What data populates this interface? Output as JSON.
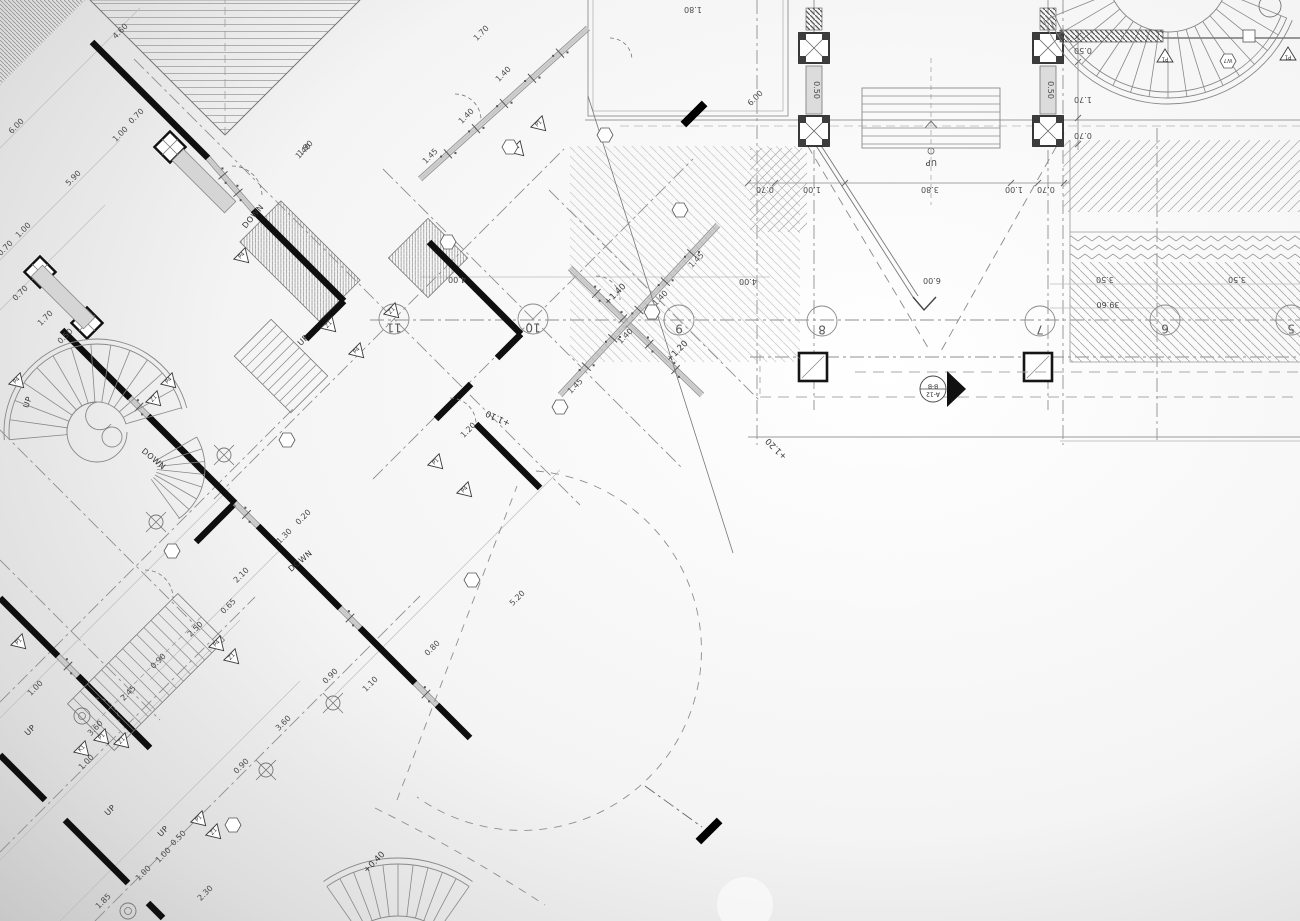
{
  "drawing_type": "architectural floor plan blueprint, partly rotated 45 degrees, with stairs, colonnade portico and terraces",
  "colors": {
    "background_edge": "#c6c6c6",
    "background_center": "#ffffff",
    "wall_ink": "#0f0f0f",
    "line_medium": "#606060",
    "line_light": "#9a9a9a",
    "hatch": "#aaaaaa",
    "stipple_fill": "#d9d9d9"
  },
  "grid_bubbles": [
    {
      "label": "11",
      "x": 394,
      "y": 319
    },
    {
      "label": "10",
      "x": 533,
      "y": 319
    },
    {
      "label": "9",
      "x": 679,
      "y": 320
    },
    {
      "label": "8",
      "x": 822,
      "y": 321
    },
    {
      "label": "7",
      "x": 1040,
      "y": 321
    },
    {
      "label": "6",
      "x": 1165,
      "y": 320
    },
    {
      "label": "5",
      "x": 1291,
      "y": 320
    }
  ],
  "section_marker": {
    "label_top": "B-B",
    "label_bottom": "A-12",
    "x": 933,
    "y": 389
  },
  "direction_labels": [
    {
      "text": "UP",
      "x": 931,
      "y": 160,
      "rot": 180
    },
    {
      "text": "UP",
      "x": 30,
      "y": 403,
      "rot": -70
    },
    {
      "text": "DOWN",
      "x": 152,
      "y": 461,
      "rot": 40
    },
    {
      "text": "DOWN",
      "x": 255,
      "y": 218,
      "rot": -50
    },
    {
      "text": "UP",
      "x": 305,
      "y": 342,
      "rot": -45
    },
    {
      "text": "DOWN",
      "x": 302,
      "y": 563,
      "rot": -40
    },
    {
      "text": "UP",
      "x": 32,
      "y": 732,
      "rot": -45
    },
    {
      "text": "UP",
      "x": 112,
      "y": 812,
      "rot": -45
    },
    {
      "text": "UP",
      "x": 165,
      "y": 833,
      "rot": -45
    }
  ],
  "elevation_labels": [
    {
      "text": "+1.40",
      "x": 617,
      "y": 296,
      "rot": -45
    },
    {
      "text": "+1.20",
      "x": 679,
      "y": 353,
      "rot": -45
    },
    {
      "text": "+1.20",
      "x": 778,
      "y": 447,
      "rot": 225
    },
    {
      "text": "+1.10",
      "x": 499,
      "y": 416,
      "rot": 205
    },
    {
      "text": "+0.40",
      "x": 376,
      "y": 864,
      "rot": -45
    }
  ],
  "dimensions": [
    {
      "text": "1.80",
      "x": 693,
      "y": 7,
      "rot": 180
    },
    {
      "text": "4.00",
      "x": 457,
      "y": 277,
      "rot": 180
    },
    {
      "text": "4.00",
      "x": 748,
      "y": 279,
      "rot": 180
    },
    {
      "text": "6.00",
      "x": 932,
      "y": 278,
      "rot": 180
    },
    {
      "text": "3.50",
      "x": 1105,
      "y": 277,
      "rot": 180
    },
    {
      "text": "3.50",
      "x": 1237,
      "y": 277,
      "rot": 180
    },
    {
      "text": "39.60",
      "x": 1108,
      "y": 302,
      "rot": 180
    },
    {
      "text": "0.70",
      "x": 765,
      "y": 187,
      "rot": 180
    },
    {
      "text": "1.00",
      "x": 812,
      "y": 187,
      "rot": 180
    },
    {
      "text": "3.80",
      "x": 930,
      "y": 187,
      "rot": 180
    },
    {
      "text": "1.00",
      "x": 1014,
      "y": 187,
      "rot": 180
    },
    {
      "text": "0.70",
      "x": 1046,
      "y": 187,
      "rot": 180
    },
    {
      "text": "0.50",
      "x": 1083,
      "y": 48,
      "rot": 180
    },
    {
      "text": "1.70",
      "x": 1083,
      "y": 97,
      "rot": 180
    },
    {
      "text": "0.70",
      "x": 1083,
      "y": 133,
      "rot": 180
    },
    {
      "text": "0.50",
      "x": 814,
      "y": 90,
      "rot": 90
    },
    {
      "text": "0.50",
      "x": 1048,
      "y": 90,
      "rot": 90
    },
    {
      "text": "1.70",
      "x": 483,
      "y": 35,
      "rot": -45
    },
    {
      "text": "1.40",
      "x": 505,
      "y": 76,
      "rot": -45
    },
    {
      "text": "1.40",
      "x": 468,
      "y": 118,
      "rot": -45
    },
    {
      "text": "1.45",
      "x": 432,
      "y": 158,
      "rot": -45
    },
    {
      "text": "1.40",
      "x": 305,
      "y": 153,
      "rot": -45
    },
    {
      "text": "6.00",
      "x": 757,
      "y": 100,
      "rot": -45
    },
    {
      "text": "1.45",
      "x": 698,
      "y": 262,
      "rot": -45
    },
    {
      "text": "1.40",
      "x": 662,
      "y": 300,
      "rot": -45
    },
    {
      "text": "1.40",
      "x": 627,
      "y": 338,
      "rot": -45
    },
    {
      "text": "1.45",
      "x": 577,
      "y": 388,
      "rot": -45
    },
    {
      "text": "1.20",
      "x": 470,
      "y": 432,
      "rot": -45
    },
    {
      "text": "4.60",
      "x": 122,
      "y": 33,
      "rot": -45
    },
    {
      "text": "1.90",
      "x": 307,
      "y": 150,
      "rot": -45
    },
    {
      "text": "0.70",
      "x": 138,
      "y": 118,
      "rot": -45
    },
    {
      "text": "1.00",
      "x": 122,
      "y": 136,
      "rot": -45
    },
    {
      "text": "6.00",
      "x": 18,
      "y": 128,
      "rot": -45
    },
    {
      "text": "5.90",
      "x": 75,
      "y": 180,
      "rot": -45
    },
    {
      "text": "1.00",
      "x": 25,
      "y": 232,
      "rot": -45
    },
    {
      "text": "0.70",
      "x": 7,
      "y": 250,
      "rot": -45
    },
    {
      "text": "0.70",
      "x": 22,
      "y": 295,
      "rot": -45
    },
    {
      "text": "1.70",
      "x": 47,
      "y": 320,
      "rot": -45
    },
    {
      "text": "0.50",
      "x": 67,
      "y": 338,
      "rot": -45
    },
    {
      "text": "0.20",
      "x": 305,
      "y": 519,
      "rot": -45
    },
    {
      "text": "1.30",
      "x": 286,
      "y": 538,
      "rot": -45
    },
    {
      "text": "2.10",
      "x": 243,
      "y": 577,
      "rot": -45
    },
    {
      "text": "5.20",
      "x": 519,
      "y": 600,
      "rot": -45
    },
    {
      "text": "0.80",
      "x": 434,
      "y": 650,
      "rot": -45
    },
    {
      "text": "1.10",
      "x": 372,
      "y": 686,
      "rot": -45
    },
    {
      "text": "0.90",
      "x": 332,
      "y": 678,
      "rot": -45
    },
    {
      "text": "2.50",
      "x": 197,
      "y": 631,
      "rot": -45
    },
    {
      "text": "0.65",
      "x": 230,
      "y": 608,
      "rot": -45
    },
    {
      "text": "2.45",
      "x": 130,
      "y": 695,
      "rot": -45
    },
    {
      "text": "0.90",
      "x": 160,
      "y": 663,
      "rot": -45
    },
    {
      "text": "1.00",
      "x": 37,
      "y": 690,
      "rot": -45
    },
    {
      "text": "3.60",
      "x": 97,
      "y": 730,
      "rot": -45
    },
    {
      "text": "1.00",
      "x": 88,
      "y": 764,
      "rot": -45
    },
    {
      "text": "0.90",
      "x": 243,
      "y": 768,
      "rot": -45
    },
    {
      "text": "3.60",
      "x": 285,
      "y": 725,
      "rot": -45
    },
    {
      "text": "1.85",
      "x": 105,
      "y": 903,
      "rot": -45
    },
    {
      "text": "1.00",
      "x": 145,
      "y": 875,
      "rot": -45
    },
    {
      "text": "1.00",
      "x": 165,
      "y": 857,
      "rot": -45
    },
    {
      "text": "0.50",
      "x": 180,
      "y": 840,
      "rot": -45
    },
    {
      "text": "2.30",
      "x": 207,
      "y": 895,
      "rot": -45
    }
  ],
  "window_markers": [
    {
      "label": "P1",
      "x": 1165,
      "y": 57,
      "rot": 180
    },
    {
      "label": "P1",
      "x": 1288,
      "y": 55,
      "rot": 180
    },
    {
      "label": "P4",
      "x": 18,
      "y": 382,
      "rot": -45
    },
    {
      "label": "P4",
      "x": 170,
      "y": 382,
      "rot": -45
    },
    {
      "label": "Z1",
      "x": 155,
      "y": 400,
      "rot": -45
    },
    {
      "label": "P1",
      "x": 540,
      "y": 125,
      "rot": -45
    },
    {
      "label": "P4",
      "x": 518,
      "y": 150,
      "rot": -45
    },
    {
      "label": "P4",
      "x": 243,
      "y": 257,
      "rot": -45
    },
    {
      "label": "Z1",
      "x": 330,
      "y": 326,
      "rot": -45
    },
    {
      "label": "Z1",
      "x": 393,
      "y": 312,
      "rot": -45
    },
    {
      "label": "P4",
      "x": 358,
      "y": 352,
      "rot": -45
    },
    {
      "label": "P1",
      "x": 437,
      "y": 463,
      "rot": -45
    },
    {
      "label": "P4",
      "x": 466,
      "y": 491,
      "rot": -45
    },
    {
      "label": "P1",
      "x": 20,
      "y": 643,
      "rot": -45
    },
    {
      "label": "P4",
      "x": 218,
      "y": 645,
      "rot": -45
    },
    {
      "label": "Z1",
      "x": 233,
      "y": 658,
      "rot": -45
    },
    {
      "label": "P1",
      "x": 103,
      "y": 738,
      "rot": -45
    },
    {
      "label": "Z1",
      "x": 123,
      "y": 742,
      "rot": -45
    },
    {
      "label": "K1",
      "x": 83,
      "y": 750,
      "rot": -45
    },
    {
      "label": "P1",
      "x": 200,
      "y": 820,
      "rot": -45
    },
    {
      "label": "Z1",
      "x": 215,
      "y": 833,
      "rot": -45
    }
  ],
  "hex_tags": [
    {
      "label": "",
      "x": 448,
      "y": 242
    },
    {
      "label": "",
      "x": 510,
      "y": 147
    },
    {
      "label": "",
      "x": 605,
      "y": 135
    },
    {
      "label": "",
      "x": 652,
      "y": 312
    },
    {
      "label": "",
      "x": 560,
      "y": 407
    },
    {
      "label": "",
      "x": 287,
      "y": 440
    },
    {
      "label": "",
      "x": 172,
      "y": 551
    },
    {
      "label": "",
      "x": 233,
      "y": 825
    },
    {
      "label": "",
      "x": 472,
      "y": 580
    },
    {
      "label": "W7",
      "x": 1228,
      "y": 61
    },
    {
      "label": "",
      "x": 680,
      "y": 210
    }
  ],
  "symbols": {
    "crosshairs": [
      {
        "x": 224,
        "y": 455
      },
      {
        "x": 156,
        "y": 522
      },
      {
        "x": 333,
        "y": 703
      },
      {
        "x": 266,
        "y": 770
      }
    ],
    "circle_targets": [
      {
        "x": 128,
        "y": 911
      },
      {
        "x": 82,
        "y": 716
      }
    ]
  }
}
